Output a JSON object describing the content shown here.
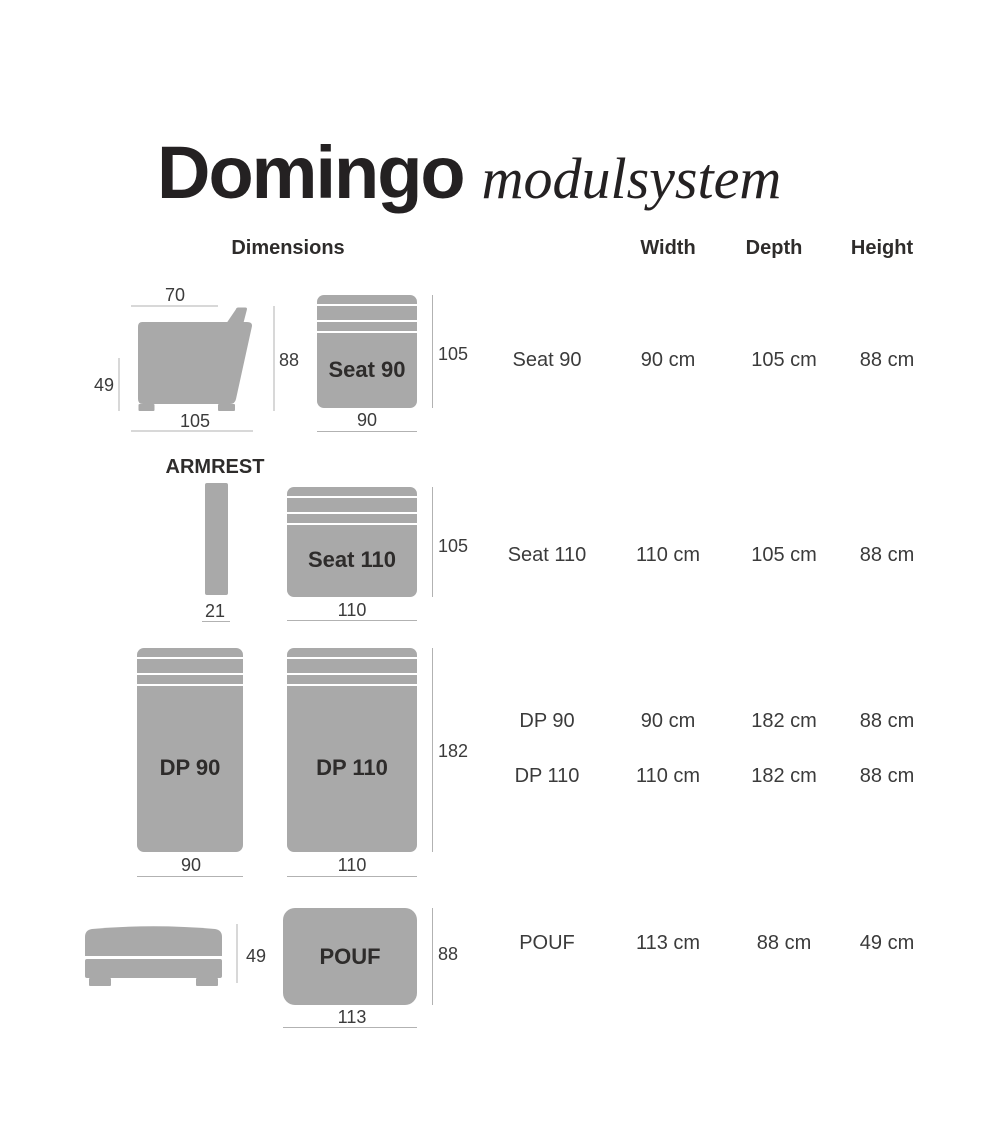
{
  "title": {
    "name": "Domingo",
    "subtitle": "modulsystem"
  },
  "headers": {
    "dimensions": "Dimensions",
    "width": "Width",
    "depth": "Depth",
    "height": "Height"
  },
  "colors": {
    "module_fill": "#a9a9a9",
    "dim_line": "#b2b2b2",
    "dim_text": "#3b3b3b",
    "label_text": "#2e2c2b",
    "title_text": "#242122",
    "background": "#ffffff"
  },
  "modules": {
    "seat90": {
      "label": "Seat 90",
      "side": {
        "top_width": "70",
        "height": "88",
        "seat_height": "49",
        "depth": "105"
      },
      "top": {
        "depth": "105",
        "width": "90"
      }
    },
    "armrest": {
      "label": "ARMREST",
      "width": "21"
    },
    "seat110": {
      "label": "Seat 110",
      "top": {
        "depth": "105",
        "width": "110"
      }
    },
    "dp90": {
      "label": "DP 90",
      "width": "90"
    },
    "dp110": {
      "label": "DP 110",
      "width": "110",
      "depth": "182"
    },
    "pouf": {
      "label": "POUF",
      "side": {
        "height": "49"
      },
      "top": {
        "depth": "88",
        "width": "113"
      }
    }
  },
  "table": {
    "rows": [
      {
        "name": "Seat 90",
        "width": "90 cm",
        "depth": "105 cm",
        "height": "88 cm"
      },
      {
        "name": "Seat 110",
        "width": "110 cm",
        "depth": "105 cm",
        "height": "88 cm"
      },
      {
        "name": "DP 90",
        "width": "90 cm",
        "depth": "182 cm",
        "height": "88 cm"
      },
      {
        "name": "DP 110",
        "width": "110 cm",
        "depth": "182 cm",
        "height": "88 cm"
      },
      {
        "name": "POUF",
        "width": "113 cm",
        "depth": "88 cm",
        "height": "49 cm"
      }
    ]
  }
}
